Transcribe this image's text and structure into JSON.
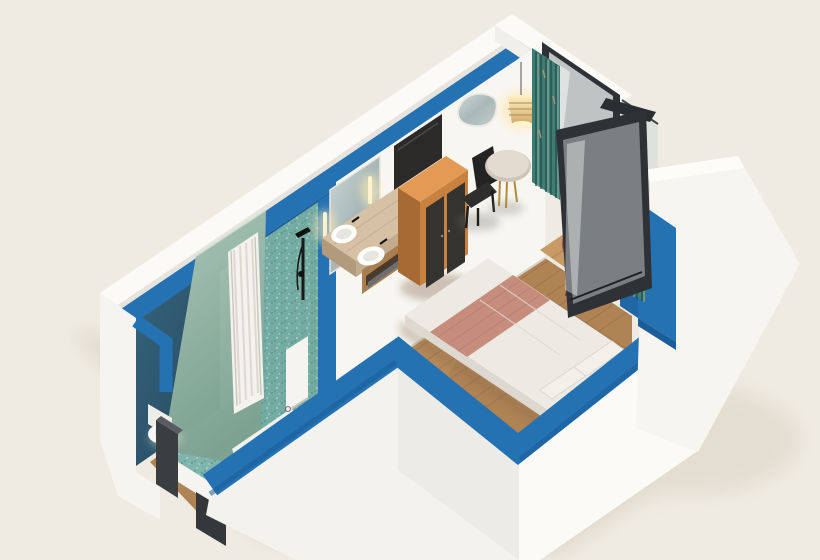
{
  "meta": {
    "title": "Isometric 3D cutaway render of a studio hotel room",
    "view": "isometric cutaway from above",
    "render_style": "3d architectural dollhouse render on cream background"
  },
  "colors": {
    "background": "#efebe2",
    "ground_shadow": "#ddd5c7",
    "wall_white": "#fbfaf6",
    "wall_white_lit": "#f4f2ec",
    "wall_white_shade": "#ecebe5",
    "cut_blue": "#2572b3",
    "cut_blue_dark": "#1b5d98",
    "petrol_accent": "#2e5a72",
    "sage_glass": "#92b0a2",
    "terrazzo_teal": "#74aca4",
    "terrazzo_floor": "#7fb5ad",
    "wood_floor": "#b08355",
    "wood_line": "#8f6a42",
    "deck_wood": "#c79a66",
    "counter_stone": "#d7c1a4",
    "cabinet_orange": "#c8823f",
    "cabinet_top": "#e29a54",
    "wardrobe_door_dark": "#34332f",
    "tv_black": "#2b2a28",
    "frame_dark": "#2e3237",
    "glass_tint": "#dde4e2",
    "curtain_teal": "#417c72",
    "bed_sheet": "#edeae3",
    "bed_runner": "#c68d7c",
    "pillow": "#f3f0e9",
    "red_chair": "#d88087",
    "lamp_glow": "#ffe9b4",
    "mirror": "#bcc7c6",
    "toilet_white": "#f7f6f2"
  },
  "scene": {
    "rooms": [
      {
        "id": "bathroom",
        "label": "bathroom",
        "features": [
          "walk-in shower with white curtain",
          "black shower fixture",
          "teal terrazzo wall and floor",
          "dark petrol accent wall",
          "leaning sage glass panel",
          "toilet",
          "double vanity with two round basins and black taps",
          "backlit mirror with two sconces"
        ]
      },
      {
        "id": "entry-hall",
        "label": "entry hall",
        "features": [
          "dark entrance door posts",
          "open white door leaf on wood floor",
          "oak plank flooring"
        ]
      },
      {
        "id": "bedroom",
        "label": "bedroom / living area",
        "features": [
          "double bed with white duvet and terracotta runner",
          "two pillows",
          "wall mounted TV",
          "orange minibar cabinet",
          "wardrobe with two dark doors",
          "black desk chair",
          "round bistro table with brass legs",
          "organic shaped wall mirror",
          "woven pendant lamp glowing",
          "teal patterned curtains"
        ]
      },
      {
        "id": "balcony",
        "label": "balcony",
        "features": [
          "black framed glass door closed",
          "black framed glass door open into room",
          "glass railing",
          "wood deck",
          "red acapulco chair"
        ]
      }
    ],
    "walls": {
      "outer_faces": "white",
      "cut_top_faces": "blue",
      "bathroom_interior": "dark petrol and teal terrazzo",
      "bedroom_interior": "white"
    }
  }
}
